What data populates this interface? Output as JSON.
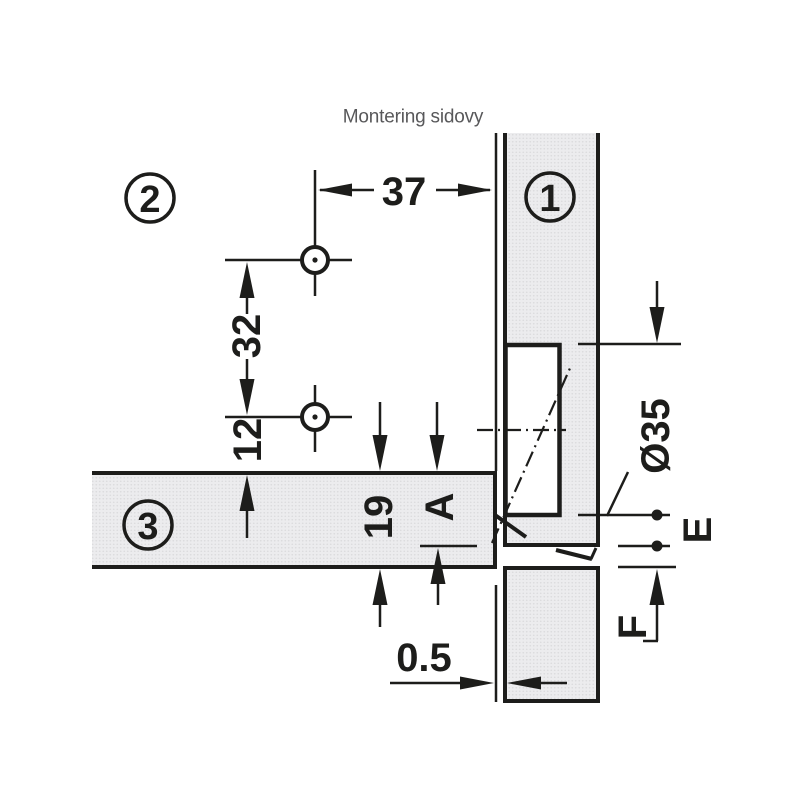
{
  "title": "Montering sidovy",
  "parts": {
    "door_label": "1",
    "cabinet_label": "2",
    "shelf_label": "3"
  },
  "dims": {
    "edge_to_holes": "37",
    "hole_spacing": "32",
    "holes_to_shelf": "12",
    "shelf_thickness": "19",
    "drilling_distance": "A",
    "cup_diameter": "Ø35",
    "cup_to_edge": "E",
    "panel_gap": "F",
    "reveal_gap": "0.5"
  },
  "colors": {
    "line": "#1d1d1b",
    "panel_fill": "#ececee",
    "panel_dot": "#dadadc",
    "title_text": "#58585a"
  }
}
